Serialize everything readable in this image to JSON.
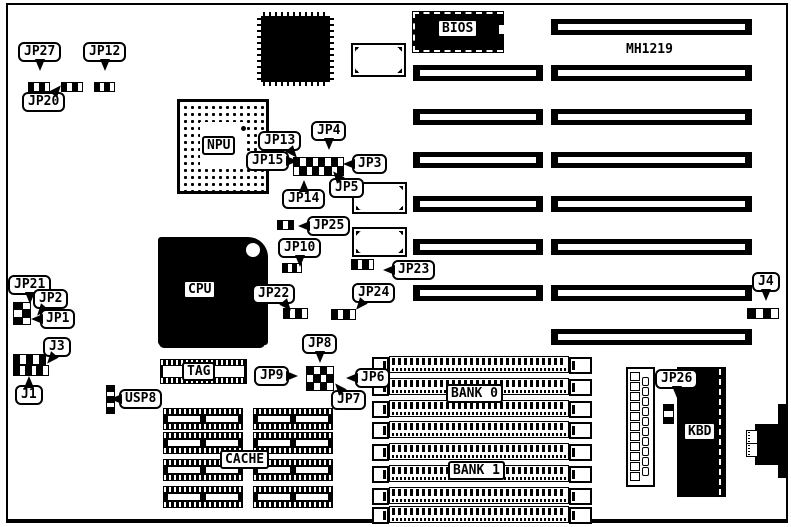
{
  "board_model": "MH1219",
  "labels": {
    "npu": "NPU",
    "cpu": "CPU",
    "bios": "BIOS",
    "tag": "TAG",
    "cache": "CACHE",
    "bank0": "BANK 0",
    "bank1": "BANK 1",
    "kbd": "KBD"
  },
  "callouts": [
    {
      "id": "jp27",
      "label": "JP27",
      "x": 18,
      "y": 42,
      "tail": "down"
    },
    {
      "id": "jp12",
      "label": "JP12",
      "x": 83,
      "y": 42,
      "tail": "down"
    },
    {
      "id": "jp20",
      "label": "JP20",
      "x": 22,
      "y": 92,
      "tail": "up-right"
    },
    {
      "id": "jp13",
      "label": "JP13",
      "x": 258,
      "y": 131,
      "tail": "down-right"
    },
    {
      "id": "jp4",
      "label": "JP4",
      "x": 311,
      "y": 121,
      "tail": "down"
    },
    {
      "id": "jp15",
      "label": "JP15",
      "x": 246,
      "y": 151,
      "tail": "right"
    },
    {
      "id": "jp3",
      "label": "JP3",
      "x": 352,
      "y": 154,
      "tail": "left"
    },
    {
      "id": "jp14",
      "label": "JP14",
      "x": 282,
      "y": 189,
      "tail": "up"
    },
    {
      "id": "jp5",
      "label": "JP5",
      "x": 329,
      "y": 178,
      "tail": "up-left"
    },
    {
      "id": "jp25",
      "label": "JP25",
      "x": 307,
      "y": 216,
      "tail": "left"
    },
    {
      "id": "jp10",
      "label": "JP10",
      "x": 278,
      "y": 238,
      "tail": "down"
    },
    {
      "id": "jp23",
      "label": "JP23",
      "x": 392,
      "y": 260,
      "tail": "left"
    },
    {
      "id": "jp22",
      "label": "JP22",
      "x": 252,
      "y": 284,
      "tail": "down-right"
    },
    {
      "id": "jp24",
      "label": "JP24",
      "x": 352,
      "y": 283,
      "tail": "down-left"
    },
    {
      "id": "jp8",
      "label": "JP8",
      "x": 302,
      "y": 334,
      "tail": "down"
    },
    {
      "id": "jp9",
      "label": "JP9",
      "x": 254,
      "y": 366,
      "tail": "right"
    },
    {
      "id": "jp6",
      "label": "JP6",
      "x": 355,
      "y": 368,
      "tail": "left"
    },
    {
      "id": "jp7",
      "label": "JP7",
      "x": 331,
      "y": 390,
      "tail": "up-left"
    },
    {
      "id": "jp21",
      "label": "JP21",
      "x": 8,
      "y": 275,
      "tail": "down"
    },
    {
      "id": "jp2",
      "label": "JP2",
      "x": 33,
      "y": 289,
      "tail": "down-left"
    },
    {
      "id": "jp1",
      "label": "JP1",
      "x": 40,
      "y": 309,
      "tail": "left"
    },
    {
      "id": "j3",
      "label": "J3",
      "x": 43,
      "y": 337,
      "tail": "down-left"
    },
    {
      "id": "j1",
      "label": "J1",
      "x": 15,
      "y": 385,
      "tail": "up"
    },
    {
      "id": "usp8",
      "label": "USP8",
      "x": 119,
      "y": 389,
      "tail": "left"
    },
    {
      "id": "j4",
      "label": "J4",
      "x": 752,
      "y": 272,
      "tail": "down"
    },
    {
      "id": "jp26",
      "label": "JP26",
      "x": 655,
      "y": 369,
      "tail": "down"
    }
  ],
  "jumpers": [
    {
      "id": "jp27-jumper",
      "x": 28,
      "y": 82,
      "w": 20,
      "h": 8,
      "cols": 4,
      "rows": 1
    },
    {
      "id": "jp20-jumper",
      "x": 61,
      "y": 82,
      "w": 20,
      "h": 8,
      "cols": 4,
      "rows": 1
    },
    {
      "id": "jp12-jumper",
      "x": 94,
      "y": 82,
      "w": 19,
      "h": 8,
      "cols": 4,
      "rows": 1
    },
    {
      "id": "npu-jumper-block",
      "x": 293,
      "y": 157,
      "w": 49,
      "h": 17,
      "cols": 8,
      "rows": 2
    },
    {
      "id": "jp25-jumper",
      "x": 277,
      "y": 220,
      "w": 15,
      "h": 8,
      "cols": 3,
      "rows": 1
    },
    {
      "id": "jp10-jumper",
      "x": 282,
      "y": 263,
      "w": 18,
      "h": 8,
      "cols": 4,
      "rows": 1
    },
    {
      "id": "jp23-jumper",
      "x": 351,
      "y": 259,
      "w": 21,
      "h": 9,
      "cols": 4,
      "rows": 1
    },
    {
      "id": "jp22-jumper",
      "x": 283,
      "y": 308,
      "w": 23,
      "h": 9,
      "cols": 4,
      "rows": 1
    },
    {
      "id": "jp24-jumper",
      "x": 331,
      "y": 309,
      "w": 23,
      "h": 9,
      "cols": 4,
      "rows": 1
    },
    {
      "id": "jp8-jumper-block",
      "x": 306,
      "y": 366,
      "w": 26,
      "h": 23,
      "cols": 4,
      "rows": 3
    },
    {
      "id": "jp21-jumper-block",
      "x": 13,
      "y": 302,
      "w": 16,
      "h": 21,
      "cols": 2,
      "rows": 3
    },
    {
      "id": "j3-header",
      "x": 13,
      "y": 354,
      "w": 31,
      "h": 9,
      "cols": 5,
      "rows": 1
    },
    {
      "id": "j1-header",
      "x": 13,
      "y": 365,
      "w": 34,
      "h": 9,
      "cols": 6,
      "rows": 1
    },
    {
      "id": "usp8-jumper",
      "x": 106,
      "y": 385,
      "w": 7,
      "h": 27,
      "cols": 1,
      "rows": 5
    },
    {
      "id": "jp26-jumper",
      "x": 663,
      "y": 404,
      "w": 9,
      "h": 18,
      "cols": 1,
      "rows": 3
    },
    {
      "id": "j4-jumper",
      "x": 747,
      "y": 308,
      "w": 30,
      "h": 9,
      "cols": 4,
      "rows": 1
    }
  ],
  "isa_slots": {
    "left_x": 413,
    "left_w": 130,
    "right_x": 551,
    "right_w": 201,
    "h": 16,
    "rows": [
      {
        "y": 19,
        "left": false
      },
      {
        "y": 65,
        "left": true
      },
      {
        "y": 109,
        "left": true
      },
      {
        "y": 152,
        "left": true
      },
      {
        "y": 196,
        "left": true
      },
      {
        "y": 239,
        "left": true
      },
      {
        "y": 285,
        "left": true
      },
      {
        "y": 329,
        "left": false
      }
    ]
  },
  "simm": {
    "body_x": 389,
    "body_w": 178,
    "h": 15,
    "cap_left_x": 372,
    "cap_left_w": 13,
    "cap_right_x": 569,
    "cap_right_w": 19,
    "ys": [
      356,
      378,
      400,
      421,
      443,
      465,
      487,
      506
    ]
  },
  "cache_sockets": {
    "cols_x": [
      163,
      253
    ],
    "w": 80,
    "h": 22,
    "ys": [
      408,
      432,
      459,
      486
    ]
  },
  "power_connector": {
    "x": 626,
    "y": 367,
    "w": 25,
    "h": 116,
    "left_holes": 11,
    "right_holes": 10
  }
}
